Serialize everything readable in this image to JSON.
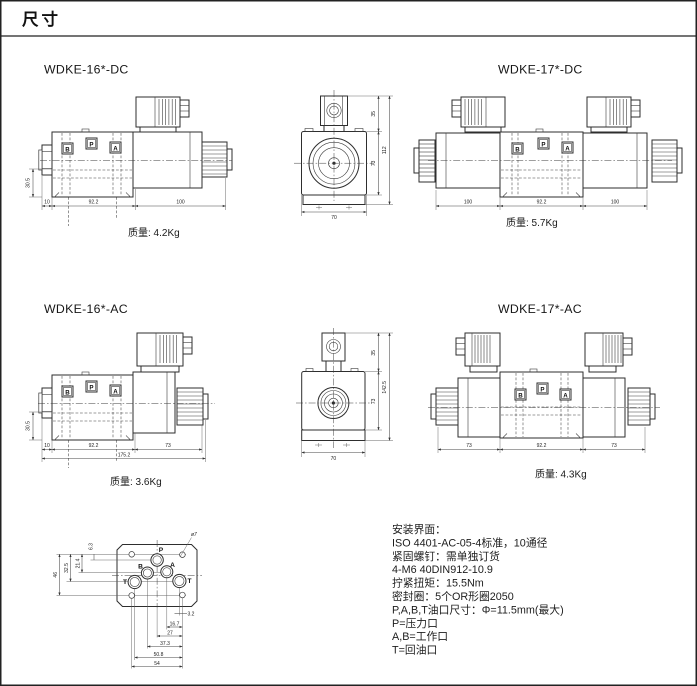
{
  "page": {
    "header": "尺寸"
  },
  "drawings": {
    "dc16": {
      "title": "WDKE-16*-DC",
      "weight": "质量: 4.2Kg",
      "ports": {
        "b": "B",
        "p": "P",
        "a": "A"
      },
      "dims": {
        "height": "30.5",
        "seg1": "10",
        "seg2": "92.2",
        "seg3": "100"
      }
    },
    "dc_front": {
      "dims": {
        "top": "35",
        "body": "73",
        "total": "112",
        "width": "70"
      }
    },
    "dc17": {
      "title": "WDKE-17*-DC",
      "weight": "质量: 5.7Kg",
      "ports": {
        "b": "B",
        "p": "P",
        "a": "A"
      },
      "dims": {
        "seg1": "100",
        "seg2": "92.2",
        "seg3": "100"
      }
    },
    "ac16": {
      "title": "WDKE-16*-AC",
      "weight": "质量: 3.6Kg",
      "ports": {
        "b": "B",
        "p": "P",
        "a": "A"
      },
      "dims": {
        "height": "30.5",
        "seg1": "10",
        "seg2": "92.2",
        "seg3": "73",
        "total": "175.2"
      }
    },
    "ac_front": {
      "dims": {
        "top": "35",
        "body": "73",
        "total": "142.5",
        "width": "70"
      }
    },
    "ac17": {
      "title": "WDKE-17*-AC",
      "weight": "质量: 4.3Kg",
      "ports": {
        "b": "B",
        "p": "P",
        "a": "A"
      },
      "dims": {
        "seg1": "73",
        "seg2": "92.2",
        "seg3": "73"
      }
    },
    "pattern": {
      "hole_callout": "ø7",
      "ports": {
        "p": "P",
        "a": "A",
        "b": "B",
        "t_left": "T",
        "t_right": "T"
      },
      "dims": {
        "v1": "6.3",
        "v2": "21.4",
        "v3": "32.5",
        "v4": "46",
        "h1": "3.2",
        "h2": "16.7",
        "h3": "27",
        "h4": "37.3",
        "h5": "50.8",
        "h6": "54"
      }
    }
  },
  "notes": {
    "lines": [
      "安装界面：",
      "ISO 4401-AC-05-4标准，10通径",
      "紧固螺钉：需单独订货",
      "4-M6 40DIN912-10.9",
      "拧紧扭矩：15.5Nm",
      "密封圈：5个OR形圈2050",
      "P,A,B,T油口尺寸：Φ=11.5mm(最大)",
      "P=压力口",
      "A,B=工作口",
      "T=回油口"
    ]
  }
}
